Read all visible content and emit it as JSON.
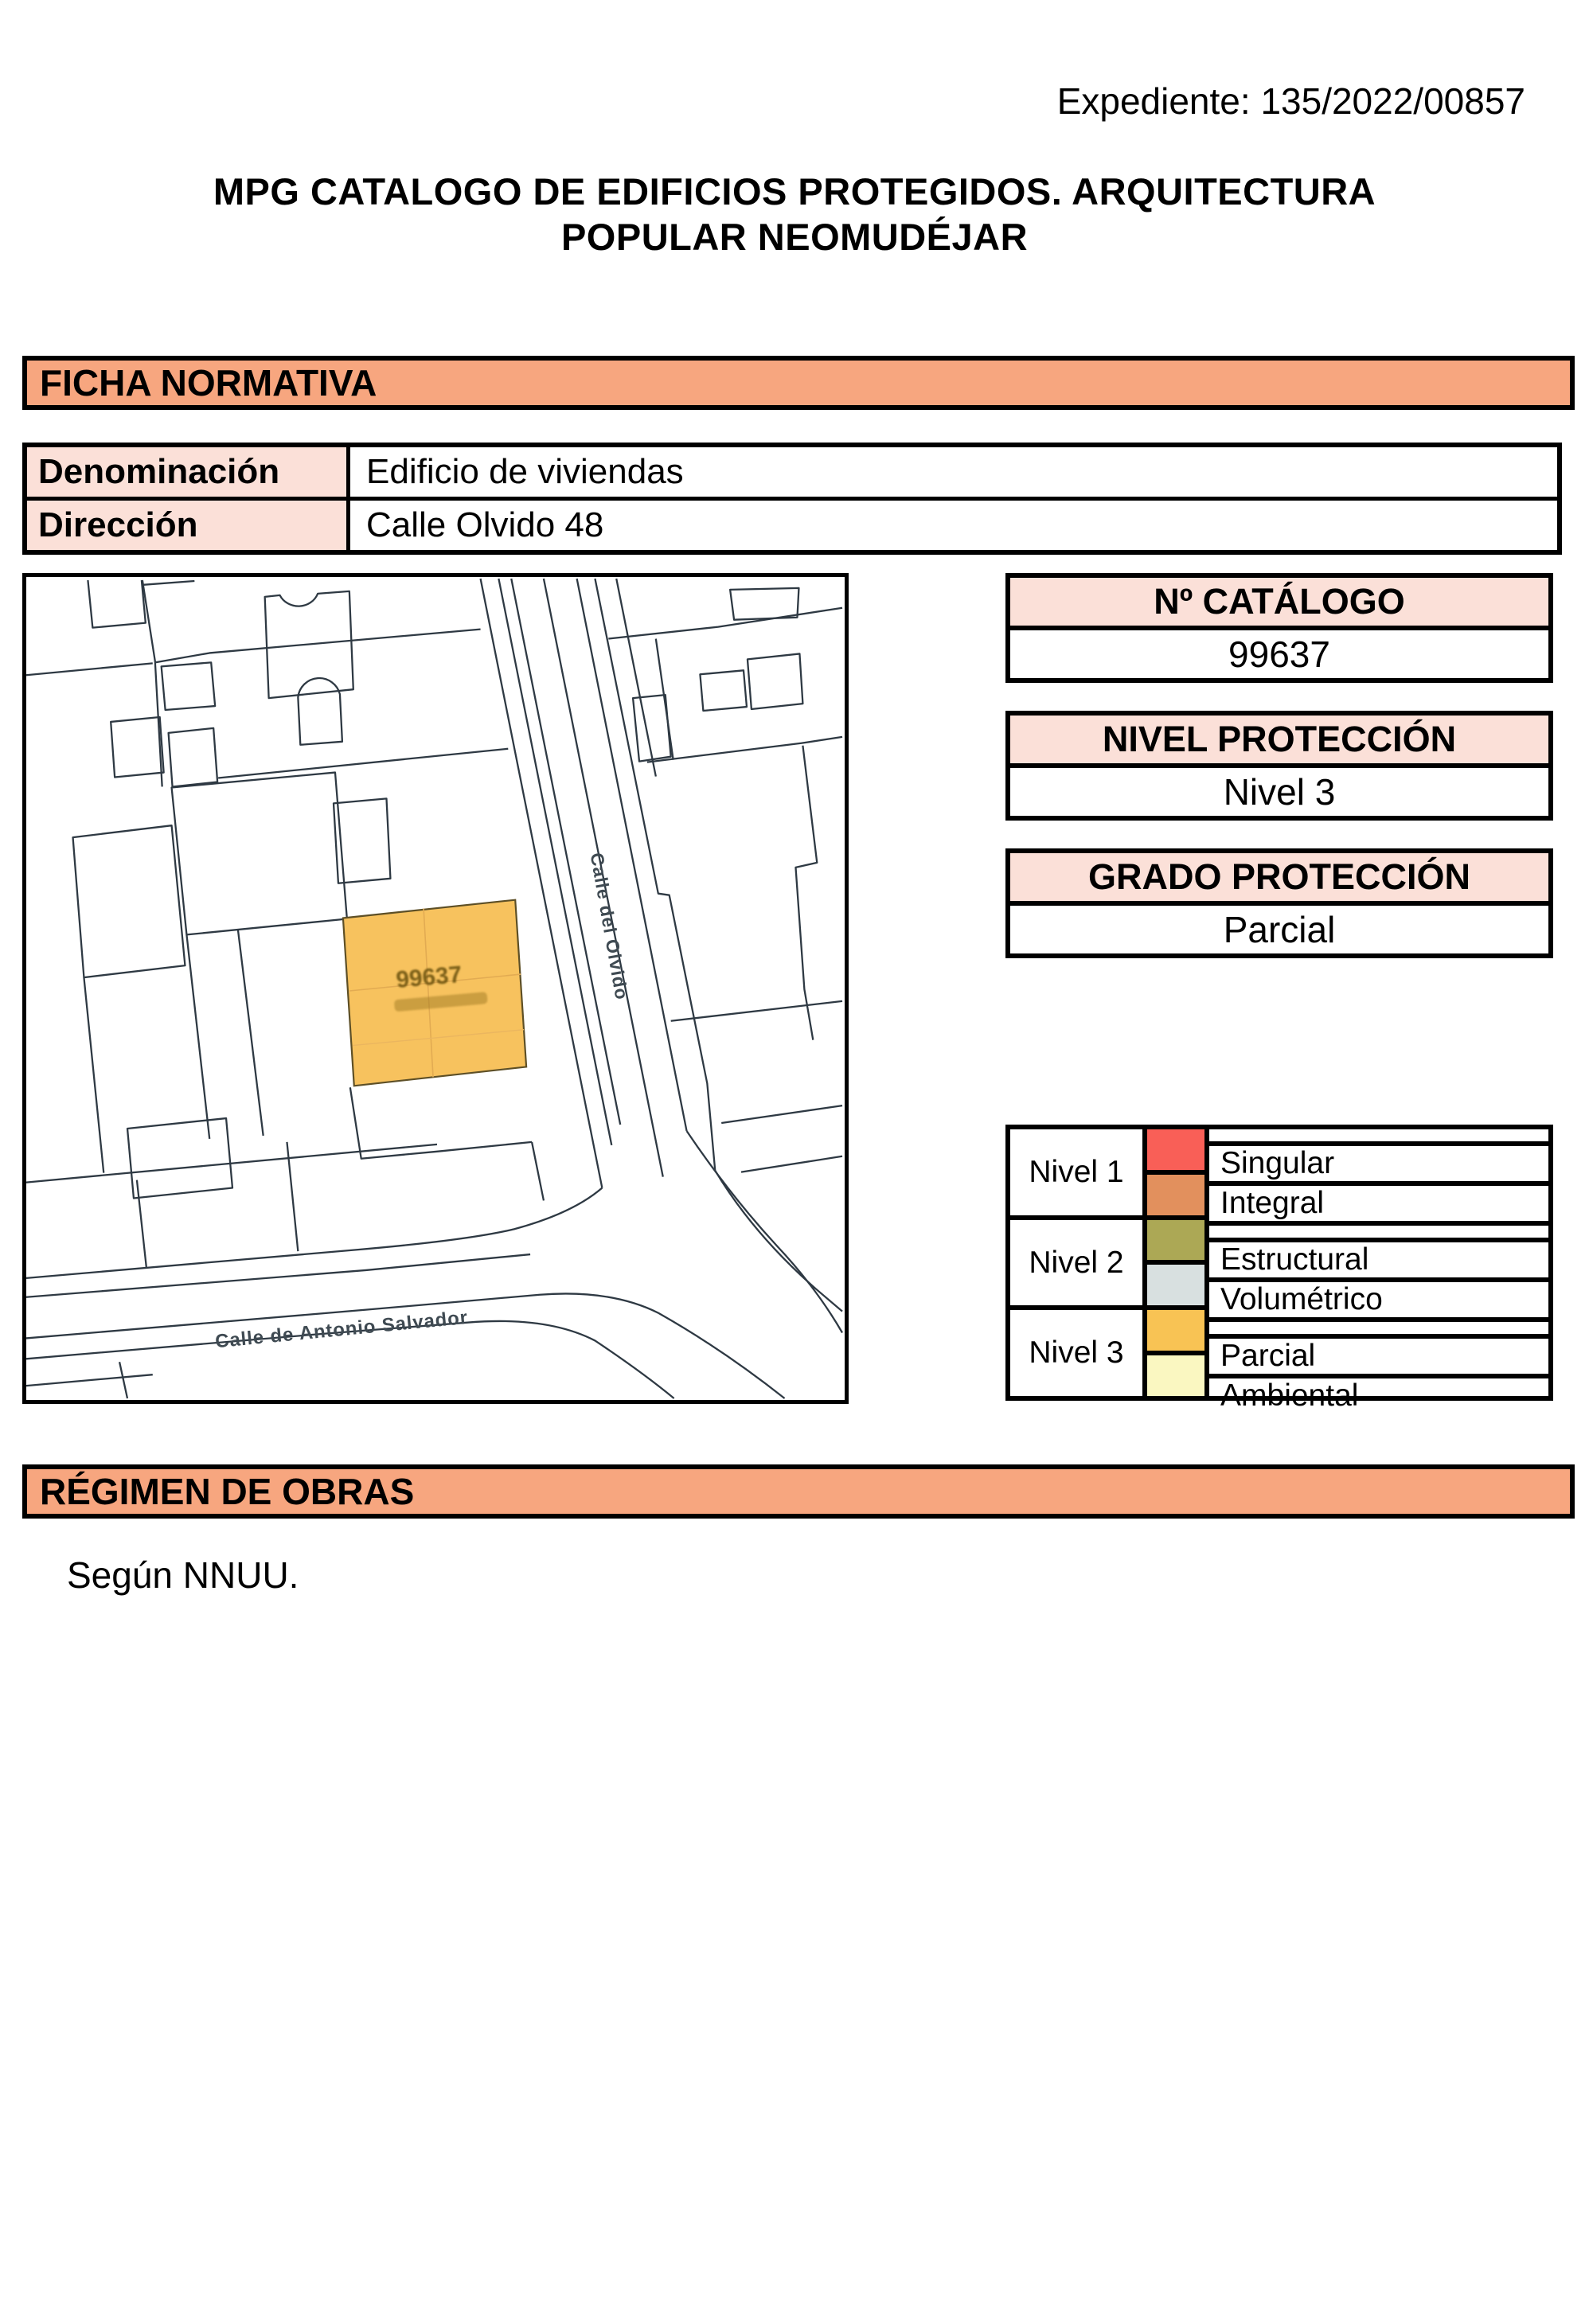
{
  "header": {
    "expediente": "Expediente: 135/2022/00857",
    "title": "MPG CATALOGO DE EDIFICIOS PROTEGIDOS. ARQUITECTURA POPULAR NEOMUDÉJAR"
  },
  "sections": {
    "ficha": "FICHA NORMATIVA",
    "regimen": "RÉGIMEN DE OBRAS"
  },
  "info_table": {
    "rows": [
      {
        "label": "Denominación",
        "value": "Edificio de viviendas"
      },
      {
        "label": "Dirección",
        "value": "Calle Olvido 48"
      }
    ]
  },
  "boxes": [
    {
      "header": "Nº CATÁLOGO",
      "value": "99637"
    },
    {
      "header": "NIVEL PROTECCIÓN",
      "value": "Nivel 3"
    },
    {
      "header": "GRADO PROTECCIÓN",
      "value": "Parcial"
    }
  ],
  "legend": {
    "groups": [
      {
        "label": "Nivel 1",
        "entries": [
          {
            "name": "Singular",
            "color": "#F95F57"
          },
          {
            "name": "Integral",
            "color": "#E2905D"
          }
        ]
      },
      {
        "label": "Nivel 2",
        "entries": [
          {
            "name": "Estructural",
            "color": "#ACA855"
          },
          {
            "name": "Volumétrico",
            "color": "#D8E0E0"
          }
        ]
      },
      {
        "label": "Nivel 3",
        "entries": [
          {
            "name": "Parcial",
            "color": "#F8C354"
          },
          {
            "name": "Ambiental",
            "color": "#FAF7C1"
          }
        ]
      }
    ]
  },
  "map": {
    "parcel_label": "99637",
    "street_vertical": "Calle del Olvido",
    "street_horizontal": "Calle de Antonio Salvador",
    "highlight_color": "#F7C25E"
  },
  "regimen_text": "Según NNUU.",
  "colors": {
    "bar_bg": "#F7A67F",
    "label_bg": "#FBE0D8"
  }
}
